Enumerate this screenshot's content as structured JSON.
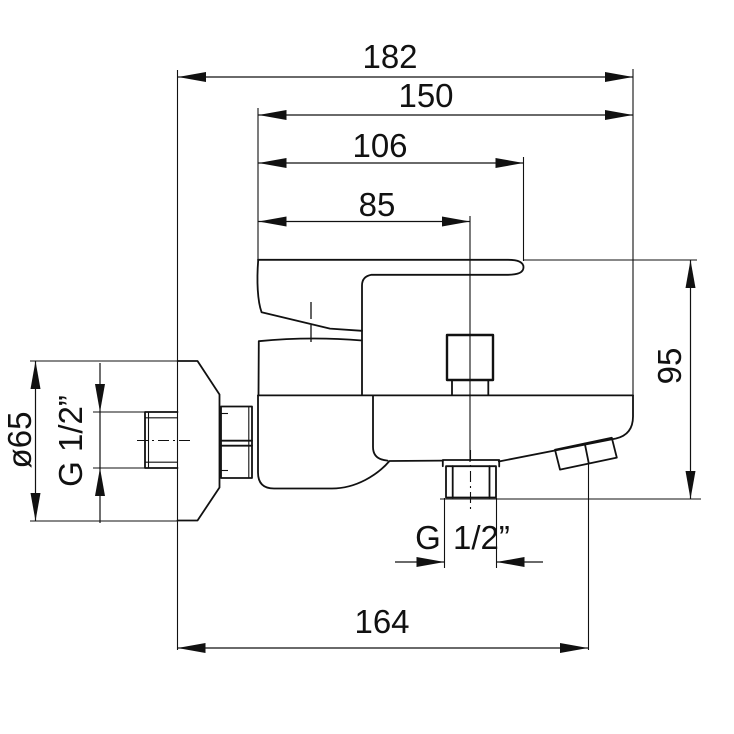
{
  "drawing": {
    "background": "#ffffff",
    "line_color": "#111111",
    "labels": {
      "dim_182": "182",
      "dim_150": "150",
      "dim_106": "106",
      "dim_85": "85",
      "dim_95": "95",
      "dim_164": "164",
      "dim_diameter": "ø65",
      "dim_thread_left": "G 1/2”",
      "dim_thread_bottom_g": "G",
      "dim_thread_bottom_size": "1/2”"
    }
  }
}
